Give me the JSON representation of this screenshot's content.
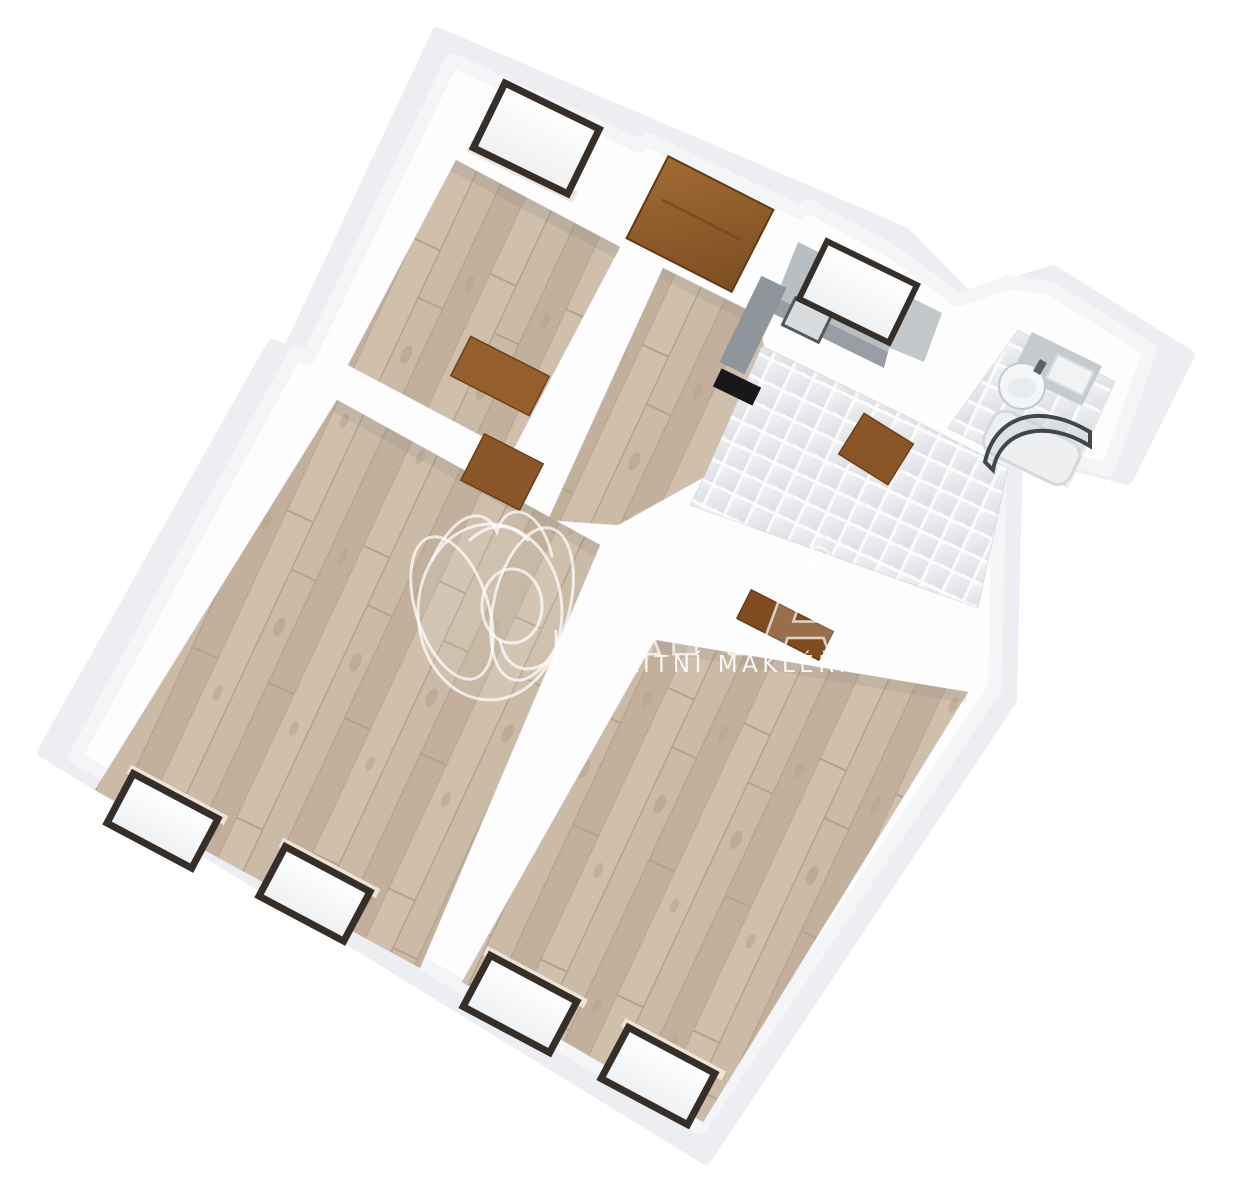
{
  "watermark": {
    "brand": "QARA",
    "brand_tail": "ARA",
    "registered_mark": "®",
    "tagline": "REALITNÍ MAKLÉŘI"
  },
  "scene": {
    "type": "3D bird's-eye floor plan render, rotated about 25 degrees",
    "rooms": [
      {
        "id": "room-top-left",
        "floor": "wood",
        "features": [
          "window-north"
        ]
      },
      {
        "id": "entry-hall",
        "floor": "wood",
        "features": [
          "entrance-door-north",
          "open-door-to-room-top-left",
          "open-door-to-living-room"
        ]
      },
      {
        "id": "kitchen-dining",
        "floor": "white-tile",
        "features": [
          "counter-with-sink",
          "tall-cabinet",
          "black-cooktop",
          "window-above-counter",
          "open-door-to-bedroom",
          "open-door-to-bathroom"
        ]
      },
      {
        "id": "bathroom",
        "floor": "white-tile",
        "features": [
          "vanity-counter",
          "round-washbasin",
          "white-cabinet",
          "bathtub",
          "curved-glass-shower-screen"
        ]
      },
      {
        "id": "living-room",
        "floor": "wood",
        "features": [
          "window-south-left",
          "window-south-right"
        ]
      },
      {
        "id": "bedroom",
        "floor": "wood",
        "features": [
          "window-south-left",
          "window-south-right"
        ]
      }
    ],
    "counts": {
      "windows": 6,
      "doors": 5
    }
  },
  "colors": {
    "background": "#ffffff",
    "wall_top": "#fdfdfe",
    "wall_shadow": "#eceef1",
    "wall_soft": "#f4f5f7",
    "wood": "#c8b7a3",
    "wood_dark": "#b5a48f",
    "tile_grout": "#fafbfc",
    "tile_face": "#e3e4e8",
    "window_frame": "#362e28",
    "window_sill": "#ece5d6",
    "door": "#95602e",
    "door_dark": "#7a4a20",
    "counter": "#b9bec2",
    "counter_front": "#989ea3",
    "cabinet_tall": "#8f969b",
    "appliance_black": "#17181a",
    "sink_steel": "#53585c",
    "glass_frame": "#41474c",
    "glass_fill": "rgba(200,209,215,0.45)",
    "watermark_white": "#ffffff"
  }
}
